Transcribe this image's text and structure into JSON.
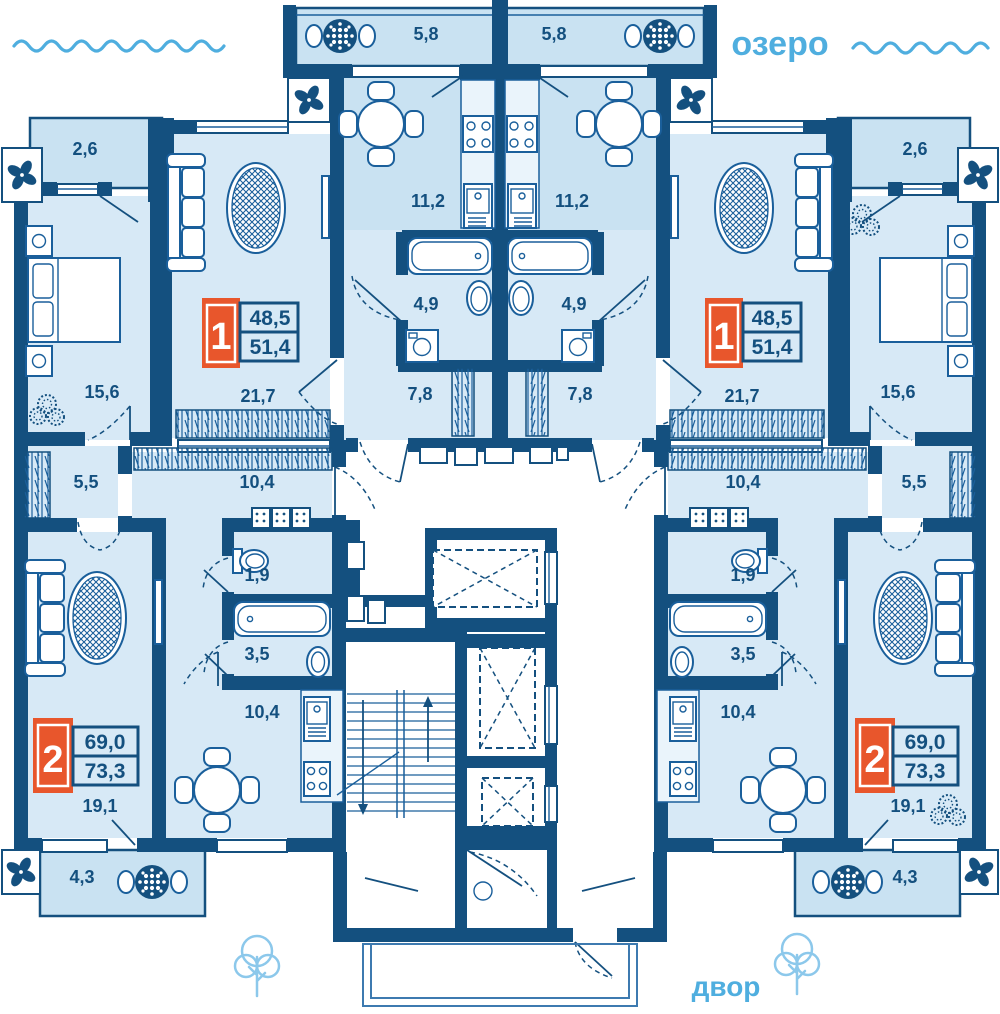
{
  "title": "Типовой этаж — план квартир",
  "legend": {
    "lake": "озеро",
    "yard": "двор"
  },
  "apartment_types": [
    {
      "number": "1",
      "area_main": "48,5",
      "area_total": "51,4"
    },
    {
      "number": "2",
      "area_main": "69,0",
      "area_total": "73,3"
    }
  ],
  "room_areas": {
    "balcony_top": "5,8",
    "balcony_side": "2,6",
    "kitchen_a": "11,2",
    "bathroom_a": "4,9",
    "hall_a": "7,8",
    "bedroom": "15,6",
    "living_a": "21,7",
    "corridor_b": "10,4",
    "hall_b": "5,5",
    "wc_b": "1,9",
    "bathroom_b": "3,5",
    "kitchen_b": "10,4",
    "living_b": "19,1",
    "balcony_bottom": "4,3"
  },
  "palette": {
    "wall": "#14507f",
    "furniture_line": "#1a5f9b",
    "room_fill": "#d7e9f6",
    "balcony_fill": "#c9e2f2",
    "accent_blue": "#4faedf",
    "tree_blue": "#8cc8eb",
    "badge_orange": "#e8562c",
    "background": "#ffffff"
  }
}
